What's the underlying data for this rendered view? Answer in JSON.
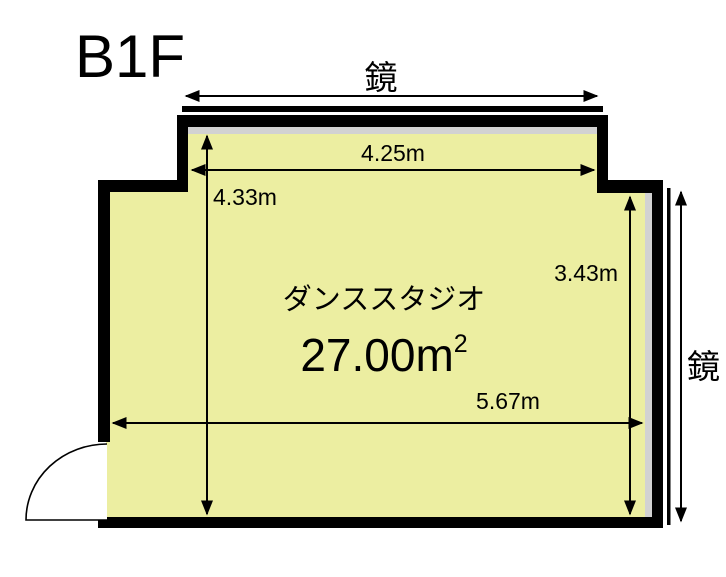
{
  "floor_label": "B1F",
  "room": {
    "name": "ダンススタジオ",
    "area_main": "27.00m",
    "area_sup": "2"
  },
  "dimensions": {
    "top_width": "4.25m",
    "left_height": "4.33m",
    "right_height": "3.43m",
    "bottom_width": "5.67m"
  },
  "mirrors": {
    "top_label": "鏡",
    "right_label": "鏡"
  },
  "colors": {
    "floor_fill": "#ECEEA1",
    "wall": "#000000",
    "mirror_strip": "#D2D2D2",
    "background": "#FFFFFF"
  }
}
